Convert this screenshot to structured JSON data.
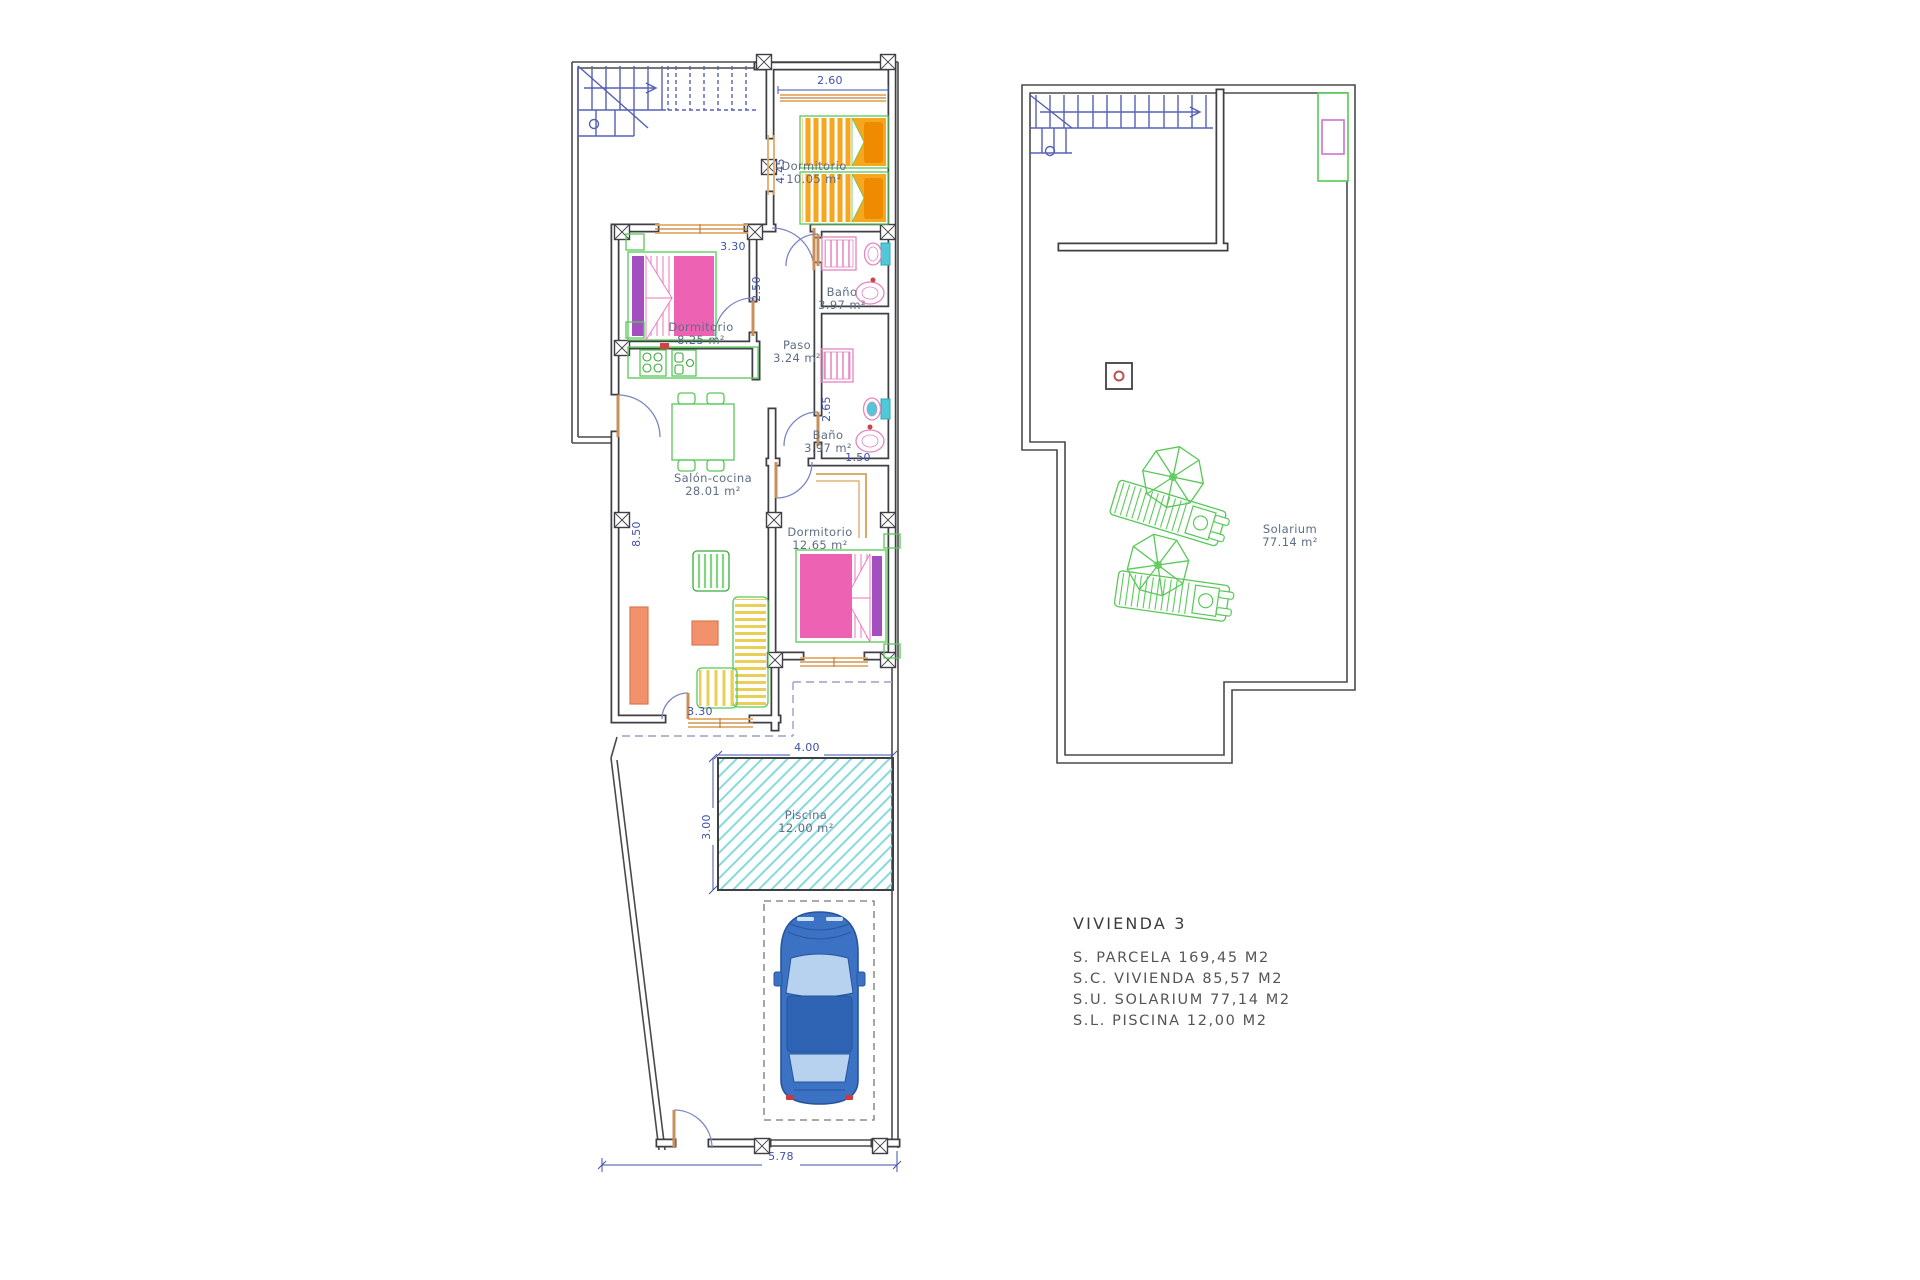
{
  "ground_floor": {
    "rooms": {
      "bedroom1": {
        "name": "Dormitorio",
        "area": "10.05 m²"
      },
      "bedroom2": {
        "name": "Dormitorio",
        "area": "8.25 m²"
      },
      "bath1": {
        "name": "Baño",
        "area": "3.97 m²"
      },
      "hall": {
        "name": "Paso",
        "area": "3.24 m²"
      },
      "bath2": {
        "name": "Baño",
        "area": "3.97 m²"
      },
      "living_kitchen": {
        "name": "Salón-cocina",
        "area": "28.01 m²"
      },
      "bedroom3": {
        "name": "Dormitorio",
        "area": "12.65 m²"
      },
      "pool": {
        "name": "Piscina",
        "area": "12.00 m²"
      }
    },
    "dimensions": {
      "bedroom1_width": "2.60",
      "bedroom1_depth": "4.45",
      "bedroom2_width": "3.30",
      "hall_depth": "2.50",
      "bath2_depth": "2.65",
      "bath2_width": "1.50",
      "living_depth": "8.50",
      "living_window_width": "3.30",
      "pool_width": "4.00",
      "pool_depth": "3.00",
      "plot_width": "5.78"
    }
  },
  "roof": {
    "rooms": {
      "solarium": {
        "name": "Solarium",
        "area": "77.14 m²"
      }
    }
  },
  "summary": {
    "title": "VIVIENDA 3",
    "rows": [
      "S.  PARCELA  169,45  M2",
      "S.C.  VIVIENDA  85,57  M2",
      "S.U.  SOLARIUM  77,14  M2",
      "S.L.  PISCINA  12,00  M2"
    ]
  },
  "colors": {
    "wall": "#3f3f46",
    "boundary": "#4a4a4a",
    "dimension_text": "#3f51a8",
    "room_label": "#5d6e85",
    "stairs": "#5560b5",
    "bed_orange": "#f6a61f",
    "pillow_orange": "#ef8b00",
    "bed_pink": "#ee62b4",
    "pillow_purple": "#a44fc0",
    "furniture_green": "#57c957",
    "table_yellow": "#f7d36e",
    "sofa_yellow": "#e9cf55",
    "salmon": "#f2926c",
    "bath_pink": "#e584c0",
    "fixture_cyan": "#4fc8d8",
    "pool_cyan": "#86dade",
    "car_blue": "#3c72c4",
    "car_glass": "#b6d2ee",
    "door_tan": "#d9a05b",
    "window_tan": "#e2a963",
    "terrace_dash": "#9aa0cc",
    "accent_red": "#cc4444"
  }
}
